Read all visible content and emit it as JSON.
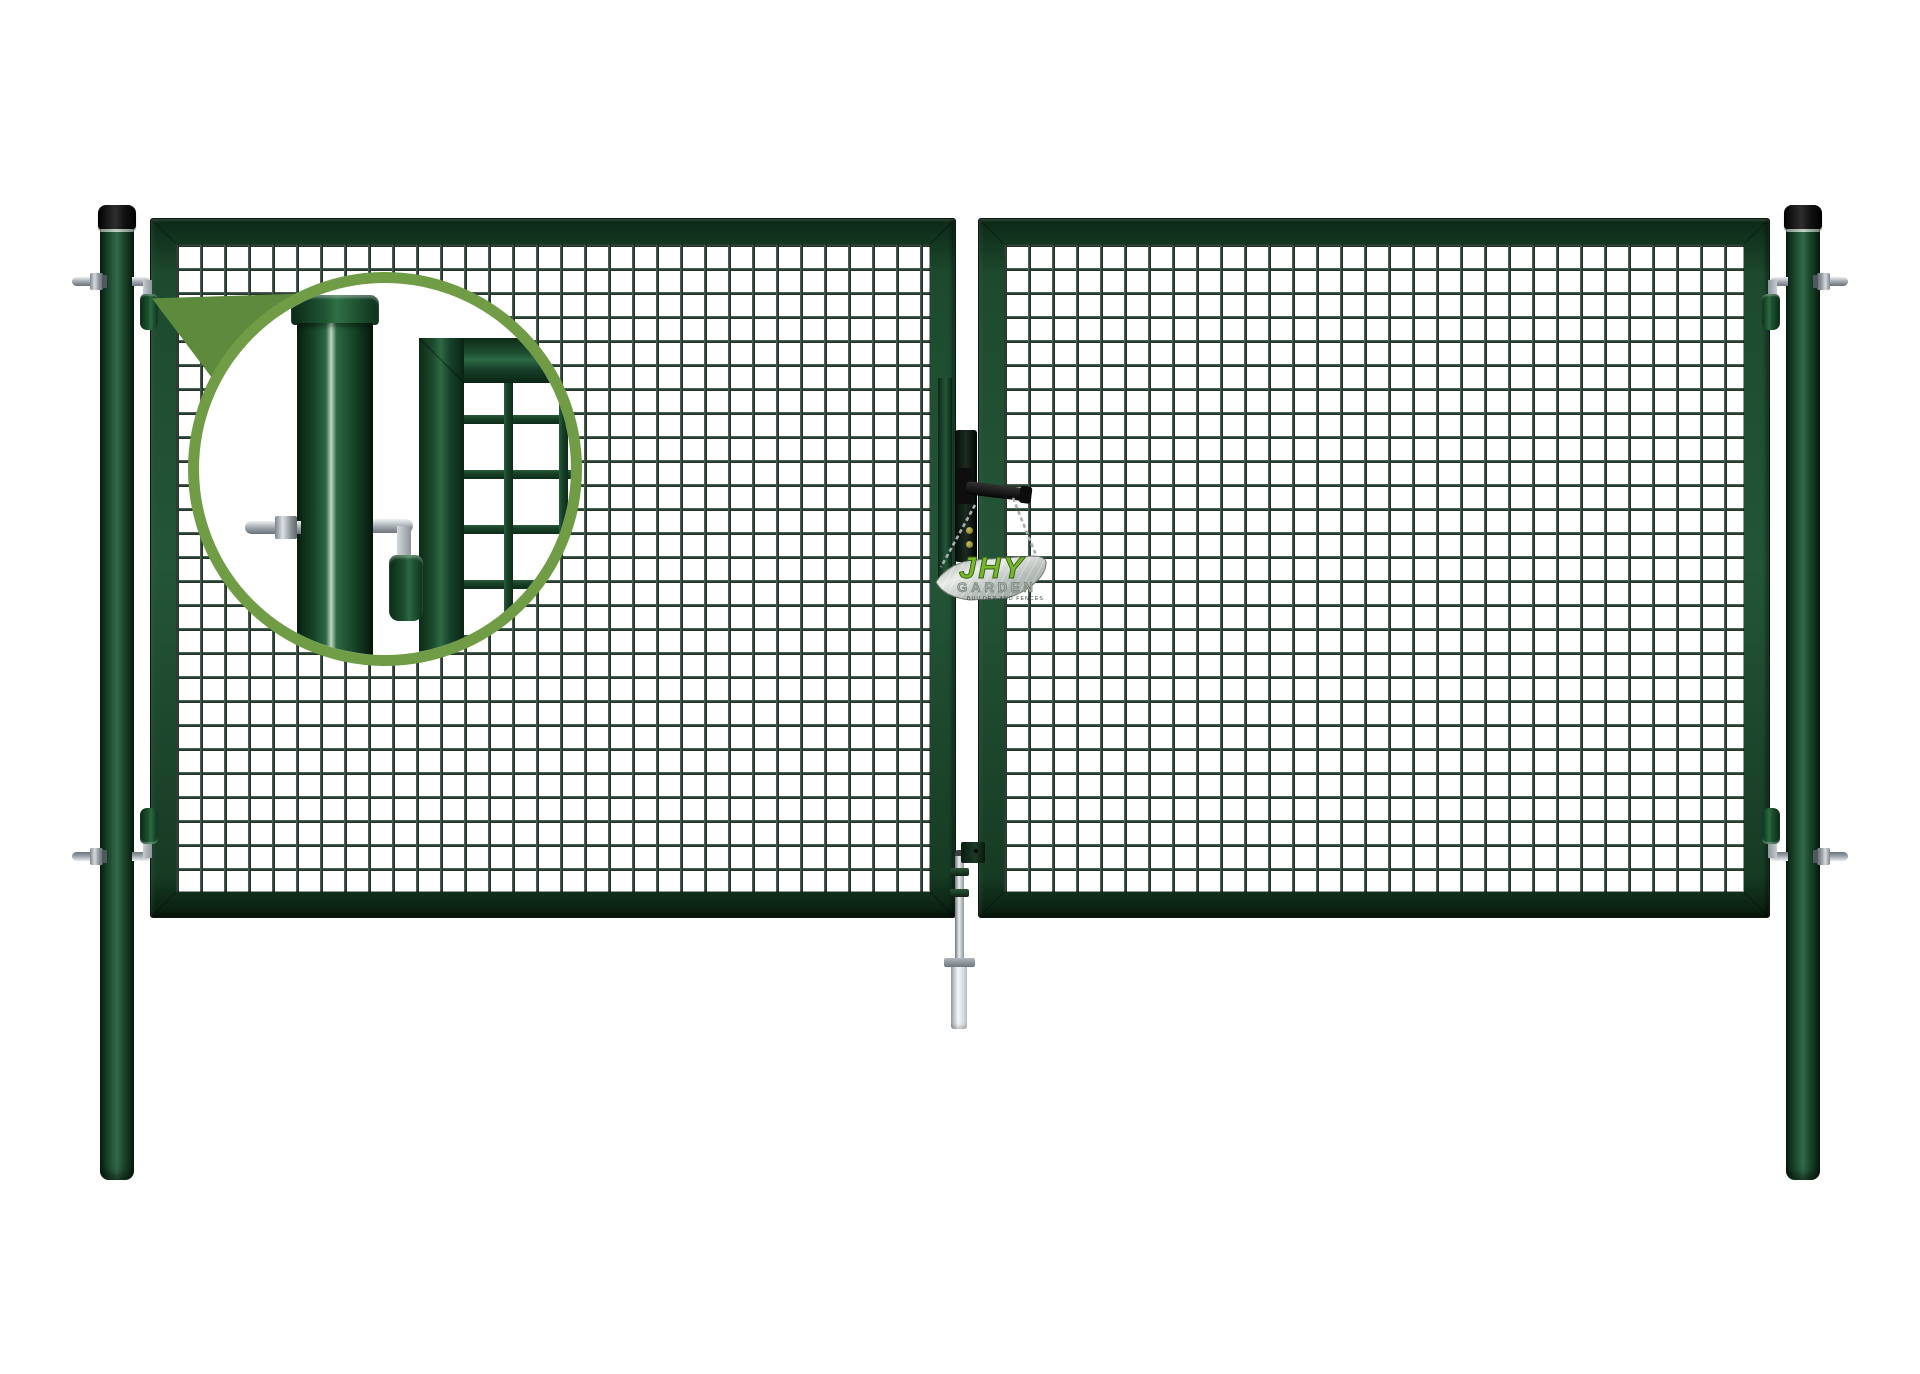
{
  "product": {
    "description": "double-wing garden gate with square wire mesh, two round posts and detail magnifier inset",
    "tag": {
      "brand": "JHY",
      "line": "GARDEN",
      "tagline": "BUILDER AND FENCES"
    },
    "colors": {
      "background": "#ffffff",
      "gate_green": "#1d4a2e",
      "gate_green_dark": "#0c2817",
      "mesh_wire": "#2c4234",
      "callout_green": "#5d8a3c",
      "callout_border": "#6f9c44",
      "post_cap_black": "#141414",
      "metal_silver": "#c3c8cc",
      "metal_dark": "#7e868c",
      "brass": "#a7a23a",
      "tag_brand_green": "#76b82a"
    }
  }
}
